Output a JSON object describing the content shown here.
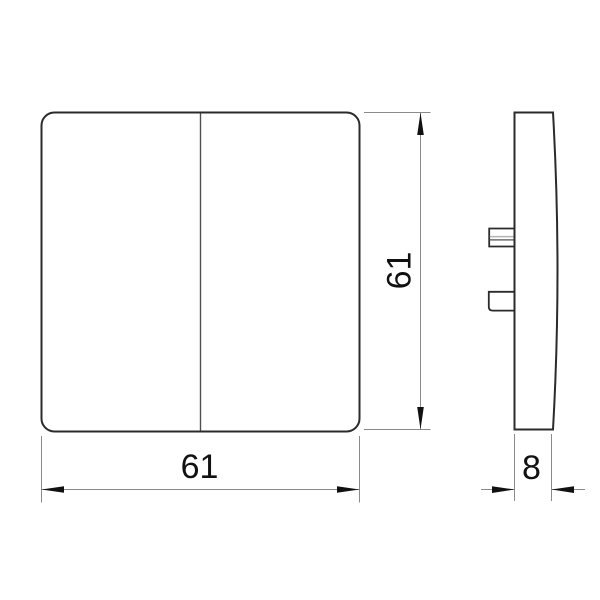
{
  "drawing": {
    "kind": "technical-drawing",
    "views": {
      "front": {
        "width_dim_label": "61",
        "height_dim_label": "61"
      },
      "side": {
        "depth_dim_label": "8"
      }
    },
    "colors": {
      "background": "#ffffff",
      "outline": "#2b2b2b",
      "divider": "#4f4f4f",
      "dimension_line": "#8a8a8a",
      "arrow_fill": "#111111",
      "text": "#111111",
      "clip_slot_light": "#b3b3b3",
      "clip_slot_dark": "#6e6e6e"
    }
  }
}
